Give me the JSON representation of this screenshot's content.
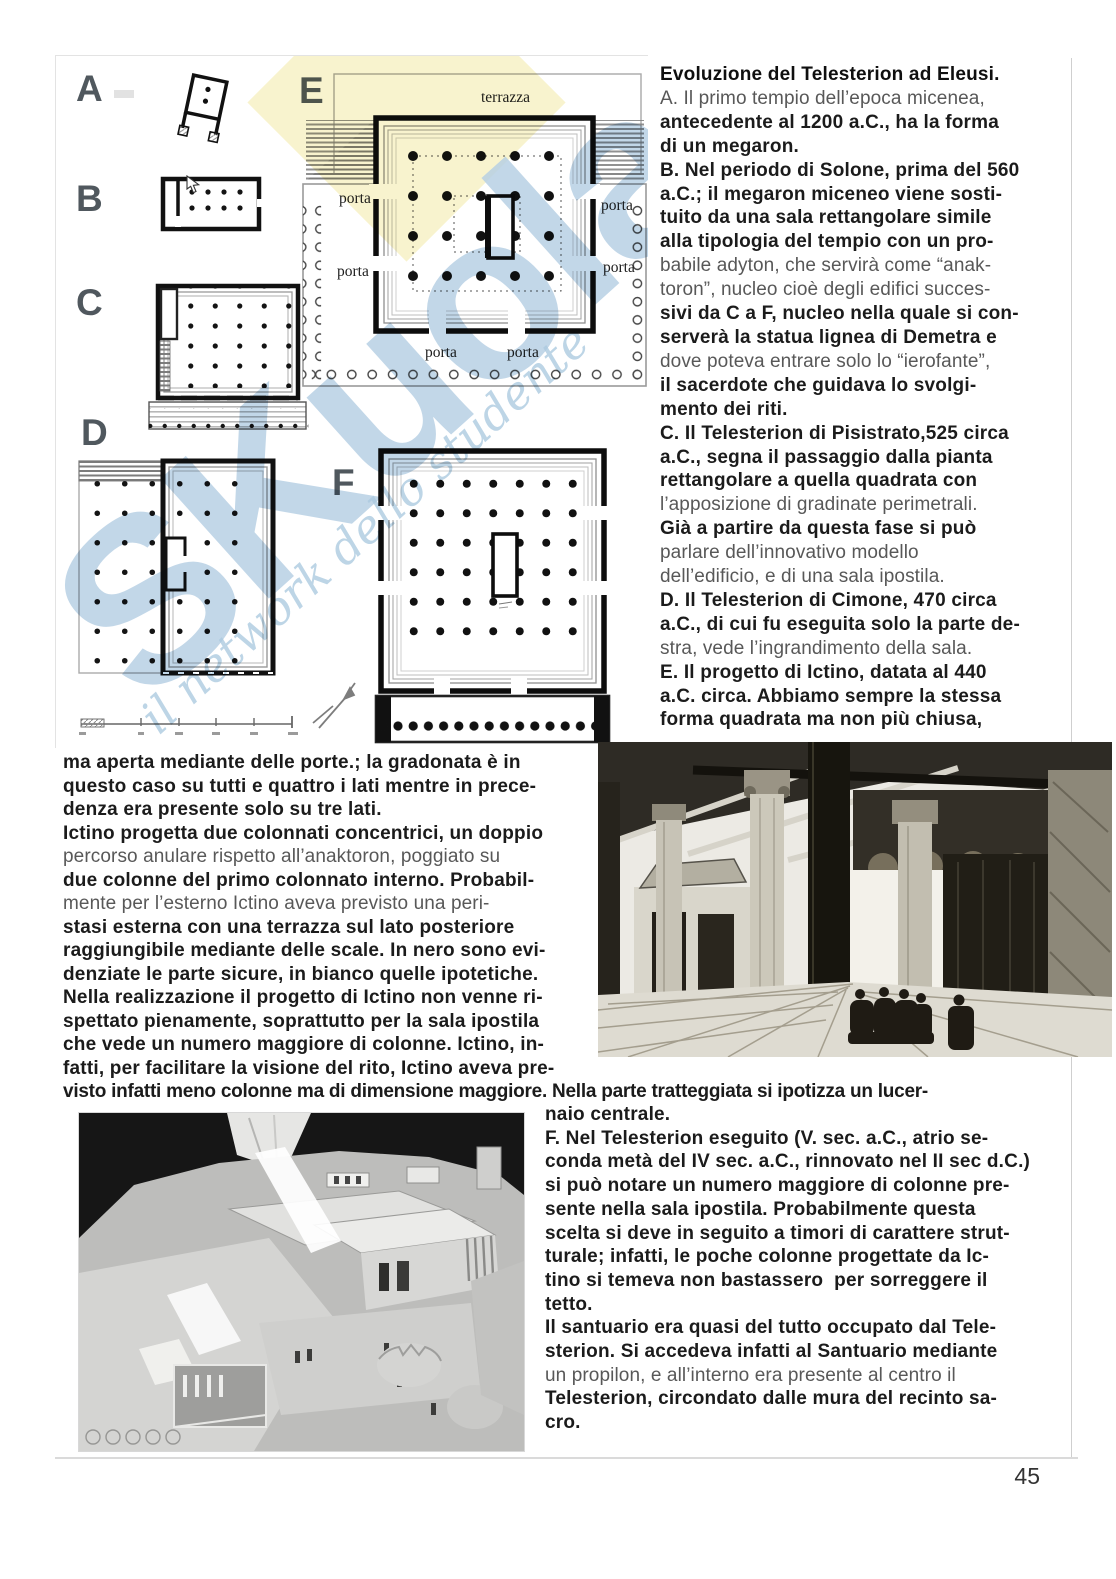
{
  "page": {
    "number": "45"
  },
  "figure": {
    "labels": [
      "A",
      "B",
      "C",
      "D",
      "E",
      "F"
    ],
    "plan_e": {
      "terrazza": "terrazza",
      "porta": "porta"
    },
    "watermark": {
      "brand": "SKuola",
      "tagline": "il network dello studente"
    }
  },
  "text": {
    "right_top": [
      {
        "t": "Evoluzione del Telesterion ad Eleusi.",
        "s": "h"
      },
      {
        "t": "A. Il primo tempio dell’epoca micenea,",
        "s": "l"
      },
      {
        "t": "antecedente al 1200 a.C., ha la forma",
        "s": "b"
      },
      {
        "t": "di un megaron.",
        "s": "b"
      },
      {
        "t": "B. Nel periodo di Solone, prima del 560",
        "s": "b"
      },
      {
        "t": "a.C.; il megaron miceneo viene sosti-",
        "s": "b"
      },
      {
        "t": "tuito da una sala rettangolare simile",
        "s": "b"
      },
      {
        "t": "alla tipologia del tempio con un pro-",
        "s": "b"
      },
      {
        "t": "babile adyton, che servirà come “anak-",
        "s": "l"
      },
      {
        "t": "toron”, nucleo cioè degli edifici succes-",
        "s": "l"
      },
      {
        "t": "sivi da C a F, nucleo nella quale si con-",
        "s": "b"
      },
      {
        "t": "serverà la statua lignea di Demetra e",
        "s": "b"
      },
      {
        "t": "dove poteva entrare solo lo “ierofante”,",
        "s": "l"
      },
      {
        "t": "il sacerdote che guidava lo svolgi-",
        "s": "b"
      },
      {
        "t": "mento dei riti.",
        "s": "b"
      },
      {
        "t": "C. Il Telesterion di Pisistrato,525 circa",
        "s": "b"
      },
      {
        "t": "a.C., segna il passaggio dalla pianta",
        "s": "b"
      },
      {
        "t": "rettangolare a quella quadrata con",
        "s": "b"
      },
      {
        "t": "l’apposizione di gradinate perimetrali.",
        "s": "l"
      },
      {
        "t": "Già a partire da questa fase si può",
        "s": "b"
      },
      {
        "t": "parlare dell’innovativo modello",
        "s": "l"
      },
      {
        "t": "dell’edificio, e di una sala ipostila.",
        "s": "l"
      },
      {
        "t": "D. Il Telesterion di Cimone, 470 circa",
        "s": "b"
      },
      {
        "t": "a.C., di cui fu eseguita solo la parte de-",
        "s": "b"
      },
      {
        "t": "stra, vede l’ingrandimento della sala.",
        "s": "l"
      },
      {
        "t": "E. Il progetto di Ictino, datata al 440",
        "s": "b"
      },
      {
        "t": "a.C. circa. Abbiamo sempre la stessa",
        "s": "b"
      },
      {
        "t": "forma quadrata ma non più chiusa,",
        "s": "b"
      }
    ],
    "left_mid": [
      {
        "t": "ma aperta mediante delle porte.; la gradonata è in",
        "s": "b"
      },
      {
        "t": "questo caso su tutti e quattro i lati mentre in prece-",
        "s": "b"
      },
      {
        "t": "denza era presente solo su tre lati.",
        "s": "b"
      },
      {
        "t": "Ictino progetta due colonnati concentrici, un doppio",
        "s": "b"
      },
      {
        "t": "percorso anulare rispetto all’anaktoron, poggiato su",
        "s": "l"
      },
      {
        "t": "due colonne del primo colonnato interno. Probabil-",
        "s": "b"
      },
      {
        "t": "mente per l’esterno Ictino aveva previsto una peri-",
        "s": "l"
      },
      {
        "t": "stasi esterna con una terrazza sul lato posteriore",
        "s": "b"
      },
      {
        "t": "raggiungibile mediante delle scale. In nero sono evi-",
        "s": "b"
      },
      {
        "t": "denziate le parte sicure, in bianco quelle ipotetiche.",
        "s": "b"
      },
      {
        "t": "Nella realizzazione il progetto di Ictino non venne ri-",
        "s": "b"
      },
      {
        "t": "spettato pienamente, soprattutto per la sala ipostila",
        "s": "b"
      },
      {
        "t": "che vede un numero maggiore di colonne. Ictino, in-",
        "s": "b"
      },
      {
        "t": "fatti, per facilitare la visione del rito, Ictino aveva pre-",
        "s": "b"
      }
    ],
    "full_line": {
      "t": "visto infatti meno colonne ma di dimensione maggiore. Nella parte tratteggiata si ipotizza un lucer-",
      "s": "b"
    },
    "right_bottom": [
      {
        "t": "naio centrale.",
        "s": "b"
      },
      {
        "t": "F. Nel Telesterion eseguito (V. sec. a.C., atrio se-",
        "s": "b"
      },
      {
        "t": "conda metà del IV sec. a.C., rinnovato nel II sec d.C.)",
        "s": "b"
      },
      {
        "t": "si può notare un numero maggiore di colonne pre-",
        "s": "b"
      },
      {
        "t": "sente nella sala ipostila. Probabilmente questa",
        "s": "b"
      },
      {
        "t": "scelta si deve in seguito a timori di carattere strut-",
        "s": "b"
      },
      {
        "t": "turale; infatti, le poche colonne progettate da Ic-",
        "s": "b"
      },
      {
        "t": "tino si temeva non bastassero  per sorreggere il",
        "s": "b"
      },
      {
        "t": "tetto.",
        "s": "b"
      },
      {
        "t": "Il santuario era quasi del tutto occupato dal Tele-",
        "s": "b"
      },
      {
        "t": "sterion. Si accedeva infatti al Santuario mediante",
        "s": "b"
      },
      {
        "t": "un propilon, e all’interno era presente al centro il",
        "s": "l"
      },
      {
        "t": "Telesterion, circondato dalle mura del recinto sa-",
        "s": "b"
      },
      {
        "t": "cro.",
        "s": "b"
      }
    ]
  }
}
